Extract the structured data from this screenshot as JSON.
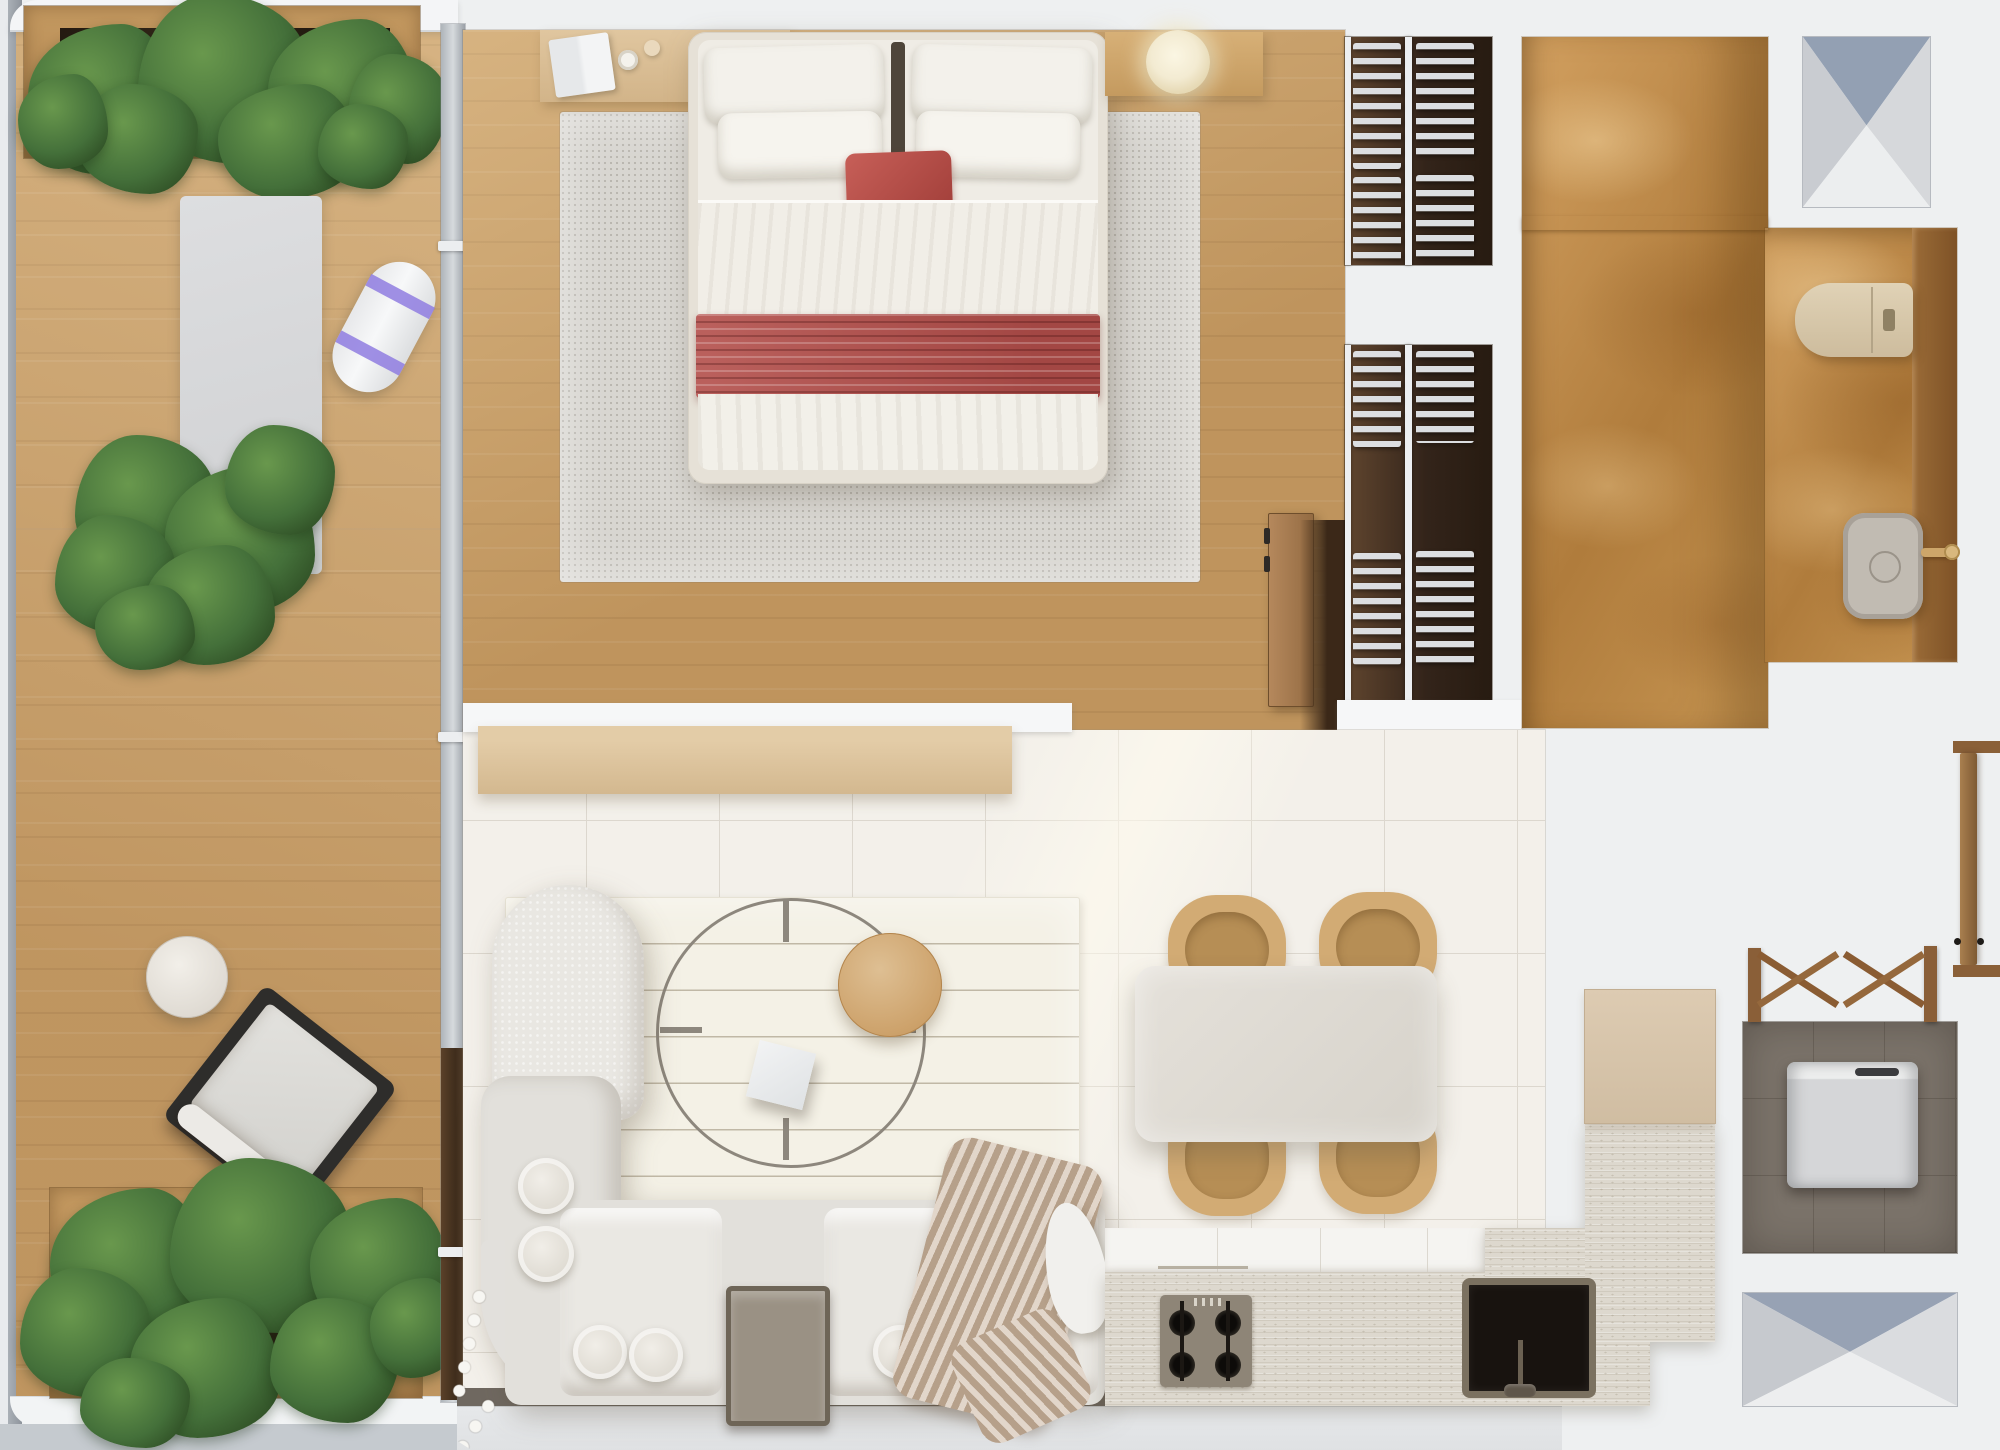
{
  "scene": {
    "type": "floor-plan-render",
    "view": "top-down",
    "description": "Photorealistic top-view floor plan of a studio apartment with wrap balcony, bedroom, walk-in closet, bathroom, open living-dining-kitchen, laundry room and two skylights"
  },
  "palette": {
    "bg": "#eef0f1",
    "wall_white": "#f6f7f8",
    "deck_wood": "#c99f68",
    "bedroom_wood": "#c79c63",
    "dark_wood": "#8a5c33",
    "door_wood": "#a97f4f",
    "closet_floor": "#3f2e1f",
    "hanger_white": "#dcdee1",
    "marble_amber": "#c99757",
    "vanity_wood": "#936537",
    "tile_floor": "#f3f0ea",
    "tile_seam": "#dcd7ce",
    "travertine": "#ddd8ce",
    "cabinet_white": "#f5f4f1",
    "cabinet_beige": "#d8c6ae",
    "sink_black": "#18130f",
    "cooktop_gray": "#8e8577",
    "sofa_fabric": "#e2e0db",
    "sofa_cushion": "#eae8e3",
    "rug_cream": "#f4f1e6",
    "bedroom_rug": "#d8d6d1",
    "accent_red": "#b5534f",
    "chair_tan": "#d2ab74",
    "chair_seat": "#b68e55",
    "table_stone": "#dfdbd4",
    "skylight_blue": "#93a0b3",
    "glass_gray": "#99a0a8",
    "plant_dark": "#2c4a22",
    "plant_mid": "#44703a",
    "plant_light": "#69984d",
    "washer_white": "#d9dadc",
    "laundry_floor": "#7b736a",
    "blanket_knit": "#cdb8a3",
    "lamp_glow": "#f6eed6",
    "metal_ring": "#8d877d",
    "wood_disc": "#d2ac77"
  },
  "rooms": [
    {
      "id": "balcony",
      "name": "Balcony",
      "furniture": [
        "planter-top",
        "yoga-mat",
        "rolled-yoga-mat",
        "planter-middle",
        "round-side-table",
        "lounge-chair",
        "planter-bottom"
      ]
    },
    {
      "id": "bedroom",
      "name": "Bedroom",
      "furniture": [
        "desk",
        "laptop",
        "double-bed",
        "four-pillows",
        "red-accent-pillow",
        "red-runner-blanket",
        "gray-area-rug",
        "nightstand",
        "sphere-lamp",
        "closet-door"
      ]
    },
    {
      "id": "walk-in-closet",
      "name": "Walk-in closet",
      "furniture": [
        "upper-hanging-rails",
        "lower-hanging-rails",
        "clothes-hangers"
      ]
    },
    {
      "id": "bathroom",
      "name": "Bathroom",
      "furniture": [
        "toilet",
        "washbasin",
        "brass-faucet",
        "vanity-counter",
        "shelf-ledge"
      ]
    },
    {
      "id": "living-room",
      "name": "Living room",
      "furniture": [
        "wall-console",
        "striped-cream-rug",
        "l-shaped-sofa",
        "wire-coffee-table",
        "wood-disc-top",
        "white-cube-stool",
        "taupe-side-table",
        "four-poufs",
        "knit-throw-blanket",
        "teardrop-armrest"
      ]
    },
    {
      "id": "dining-area",
      "name": "Dining area",
      "furniture": [
        "stone-dining-table",
        "four-tan-chairs"
      ]
    },
    {
      "id": "kitchen",
      "name": "Kitchen",
      "furniture": [
        "white-base-cabinets",
        "travertine-counter",
        "gas-cooktop",
        "black-undermount-sink",
        "tall-beige-cabinet"
      ]
    },
    {
      "id": "laundry",
      "name": "Laundry room",
      "furniture": [
        "washing-machine",
        "wooden-drying-rack"
      ]
    },
    {
      "id": "entry",
      "name": "Entry",
      "furniture": [
        "open-entry-door"
      ]
    }
  ],
  "skylights": {
    "count": 2,
    "positions": [
      "top-right",
      "bottom-right"
    ]
  },
  "counts": {
    "plant_clusters": 3,
    "dining_chairs": 4,
    "bed_pillows": 4,
    "closet_rail_sections": 4
  }
}
